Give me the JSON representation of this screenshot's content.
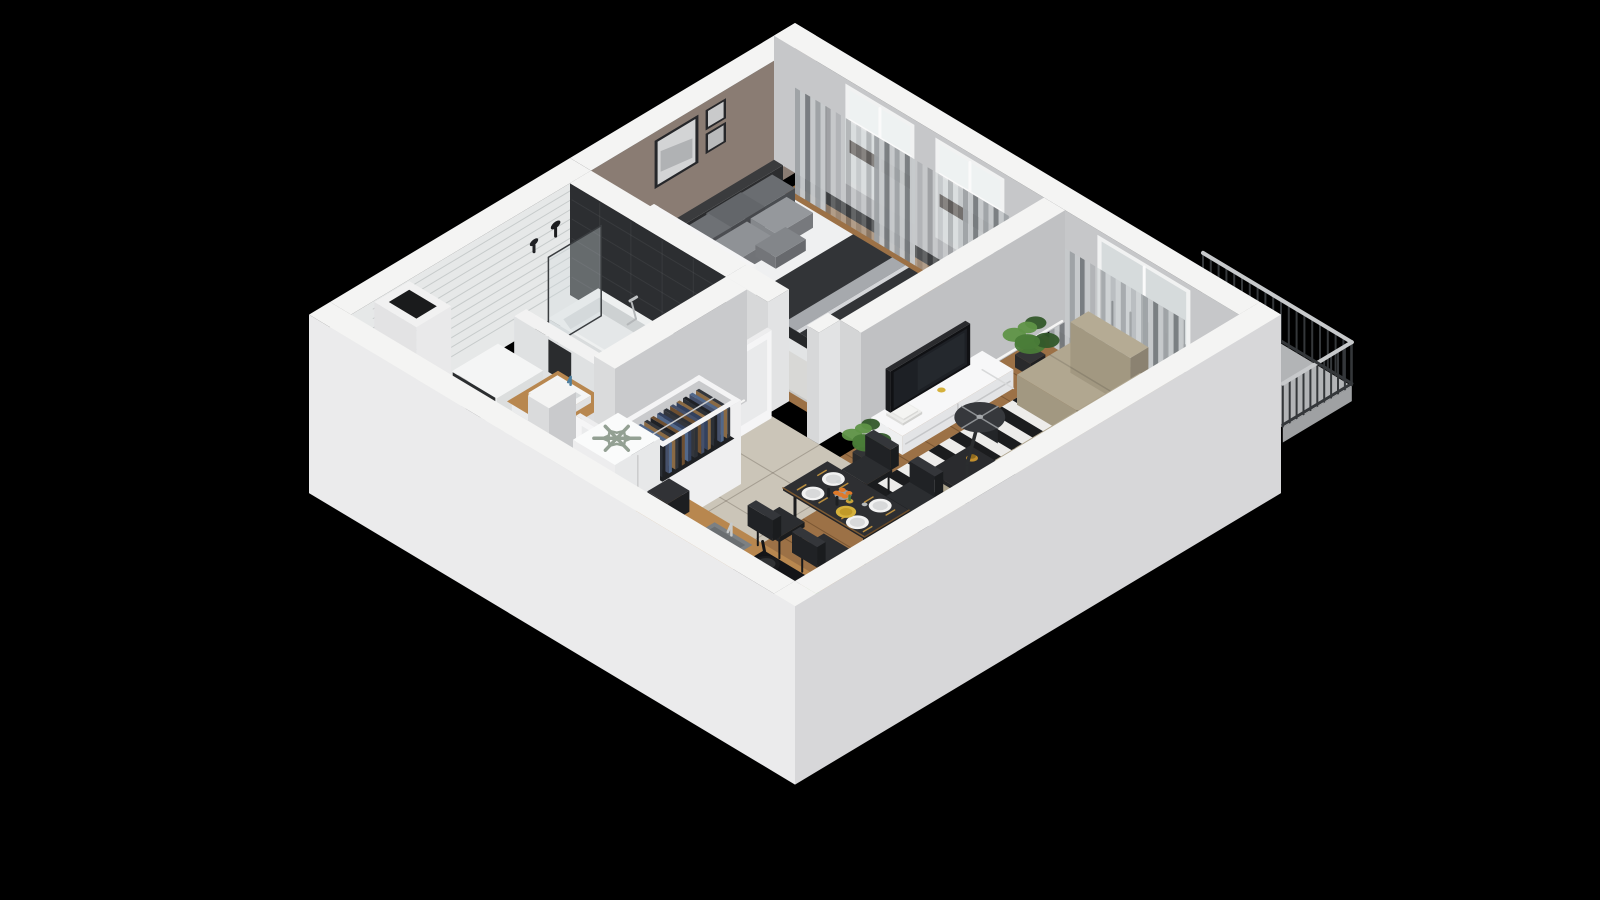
{
  "meta": {
    "description": "3D isometric cutaway floor plan rendering of a one-bedroom apartment with white cut walls on a black background",
    "view": "isometric bird's-eye cutaway, no visible text or UI controls"
  },
  "palette": {
    "bg": "#000000",
    "wallTop": "#f4f4f3",
    "wallOuterSW": "#ebebec",
    "wallOuterSE": "#d7d7d9",
    "wallInnerGrey": "#c6c7c9",
    "dividerGrey": "#c0c1c3",
    "bedroomWall": "#8a7c73",
    "bathWallTile": "#e6e8e8",
    "darkTile": "#2c2e31",
    "woodFloor": "#9c7146",
    "tileHall": "#cbc5b8",
    "bathFloor": "#f2f3f4",
    "balconyFloor": "#b2b4b6",
    "curtainDark": "#787c7f",
    "curtainMid": "#9ea2a5",
    "curtainLight": "#c6c9cb",
    "windowFrame": "#f1f2f2",
    "windowGlass": "#ccd3d5",
    "windowBright": "#eef2f2",
    "transomDark": "#493e37",
    "bedLinen": "#eff0f1",
    "bedLinenShade": "#dcdedf",
    "headboard": "#2c2d2f",
    "throwDark": "#323437",
    "throwStripe": "#a6a9ad",
    "pillowDark": "#57595d",
    "pillowMid": "#85888c",
    "bedroomRug": "#d8d8d6",
    "nightstand": "#232427",
    "brass": "#b98d3e",
    "rugBlack": "#1b1c1e",
    "rugWhite": "#edecea",
    "sofa": "#a29881",
    "sofaShade": "#8b8271",
    "sofaLight": "#b1a790",
    "chairBlack": "#202225",
    "tableBlack": "#232427",
    "consoleWhite": "#f7f7f8",
    "consoleShade": "#e3e4e6",
    "tvBlack": "#101114",
    "tvScreen": "#1d2025",
    "plantGreen": "#4a7c38",
    "plantGreenDark": "#33592a",
    "plantGreenLight": "#5f9447",
    "potDark": "#292a2c",
    "counterWood": "#b8874f",
    "cabinetFront": "#eaebec",
    "cabinetShade": "#dcdddf",
    "sinkGrey": "#7c8083",
    "cooktop": "#131417",
    "panBlack": "#1a1b1d",
    "fridgeWhite": "#fafbfb",
    "snowflake": "#93a093",
    "fruitGreen": "#6cae3b",
    "fruitOrange": "#e07a2a",
    "plateWhite": "#f2f2f2",
    "plateYellow": "#d5b13c",
    "railing": "#34373a",
    "railingLight": "#c7c9cb",
    "doorWhite": "#f5f5f6",
    "towel": "#2a2c2e",
    "clothes": [
      "#33415e",
      "#6e4f30",
      "#33363c",
      "#52688a",
      "#1f2125",
      "#8a6a44",
      "#45506a",
      "#2c3036"
    ]
  },
  "scene": {
    "background": "#000000",
    "rooms": [
      {
        "id": "bedroom",
        "label": "Bedroom",
        "floor": "wood plank",
        "wall_finish": "taupe",
        "items": [
          "double-bed",
          "headboard",
          "pillows",
          "throw-blanket",
          "nightstand",
          "table-lamp",
          "small-plant",
          "wall-art-large",
          "wall-art-small",
          "open-wardrobe-bedroom",
          "area-rug",
          "curtains-bedroom",
          "window-1",
          "window-2"
        ]
      },
      {
        "id": "bathroom",
        "label": "Bathroom",
        "floor": "white tile with black diamond accents",
        "wall_finish": "white subway tile with dark feature tile",
        "items": [
          "bathtub",
          "shower-glass-screen",
          "shower-heads",
          "tub-mixer",
          "half-wall",
          "towel",
          "vanity-sink",
          "washing-machine",
          "service-shaft"
        ]
      },
      {
        "id": "hallway",
        "label": "Hallway",
        "floor": "beige tile",
        "items": [
          "open-closet-hall",
          "bedroom-door",
          "bathroom-door",
          "entry-recess"
        ]
      },
      {
        "id": "kitchen",
        "label": "Kitchen",
        "floor": "beige tile",
        "items": [
          "refrigerator",
          "snowflake-icon",
          "coffee-machine",
          "kitchen-counter",
          "kitchen-sink",
          "cooktop",
          "pans",
          "fruit-bowl"
        ]
      },
      {
        "id": "living-dining",
        "label": "Living / Dining room",
        "floor": "wood plank",
        "items": [
          "dining-table",
          "table-setting",
          "dining-chairs",
          "striped-rug",
          "corner-sofa",
          "coffee-table",
          "amber-vase",
          "arc-floor-lamp",
          "media-console",
          "tv",
          "books",
          "console-cup",
          "plant-window",
          "plant-dining",
          "plant-sofa",
          "curtains-living",
          "balcony-door"
        ]
      },
      {
        "id": "balcony",
        "label": "Balcony",
        "floor": "concrete",
        "items": [
          "balcony-railing"
        ]
      }
    ],
    "structure": [
      "exterior-walls",
      "interior-walls",
      "floors",
      "windows",
      "doors",
      "ventilation-shaft"
    ],
    "counts": {
      "dining_chairs": 4,
      "dining_plates": 4,
      "bed_pillows": 6,
      "wall_art_frames": 3,
      "rug_stripes": 16,
      "pans": 2
    }
  }
}
